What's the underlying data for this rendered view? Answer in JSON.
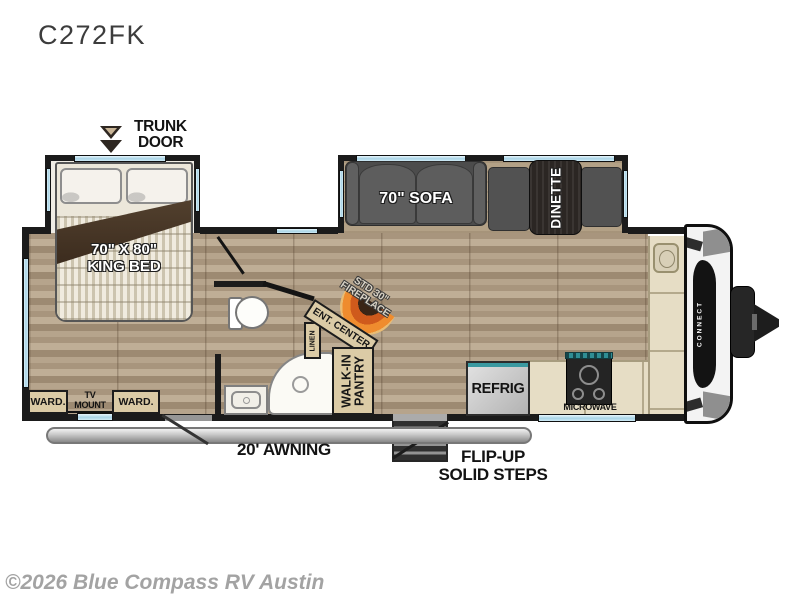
{
  "title": "C272FK",
  "watermark": "©2026 Blue Compass RV Austin",
  "colors": {
    "wall": "#1b1b1b",
    "window_blue": "#a9d4e6",
    "wood_floor": "#ae9b83",
    "cabinet_tan": "#dbcba6",
    "fireplace_orange": "#ef8c2e",
    "appliance_teal": "#2f8d94"
  },
  "labels": {
    "trunk_door_l1": "TRUNK",
    "trunk_door_l2": "DOOR",
    "king_bed_l1": "70\" X 80\"",
    "king_bed_l2": "KING BED",
    "sofa": "70\" SOFA",
    "dinette": "DINETTE",
    "fireplace_l1": "STD 30\"",
    "fireplace_l2": "FIREPLACE",
    "ent_center": "ENT. CENTER",
    "linen": "LINEN",
    "pantry_l1": "WALK-IN",
    "pantry_l2": "PANTRY",
    "ward_left": "WARD.",
    "ward_right": "WARD.",
    "tv_mount_l1": "TV",
    "tv_mount_l2": "MOUNT",
    "awning": "20' AWNING",
    "steps_l1": "FLIP-UP",
    "steps_l2": "SOLID STEPS",
    "refrig": "REFRIG",
    "microwave": "MICROWAVE",
    "brand": "CONNECT"
  }
}
